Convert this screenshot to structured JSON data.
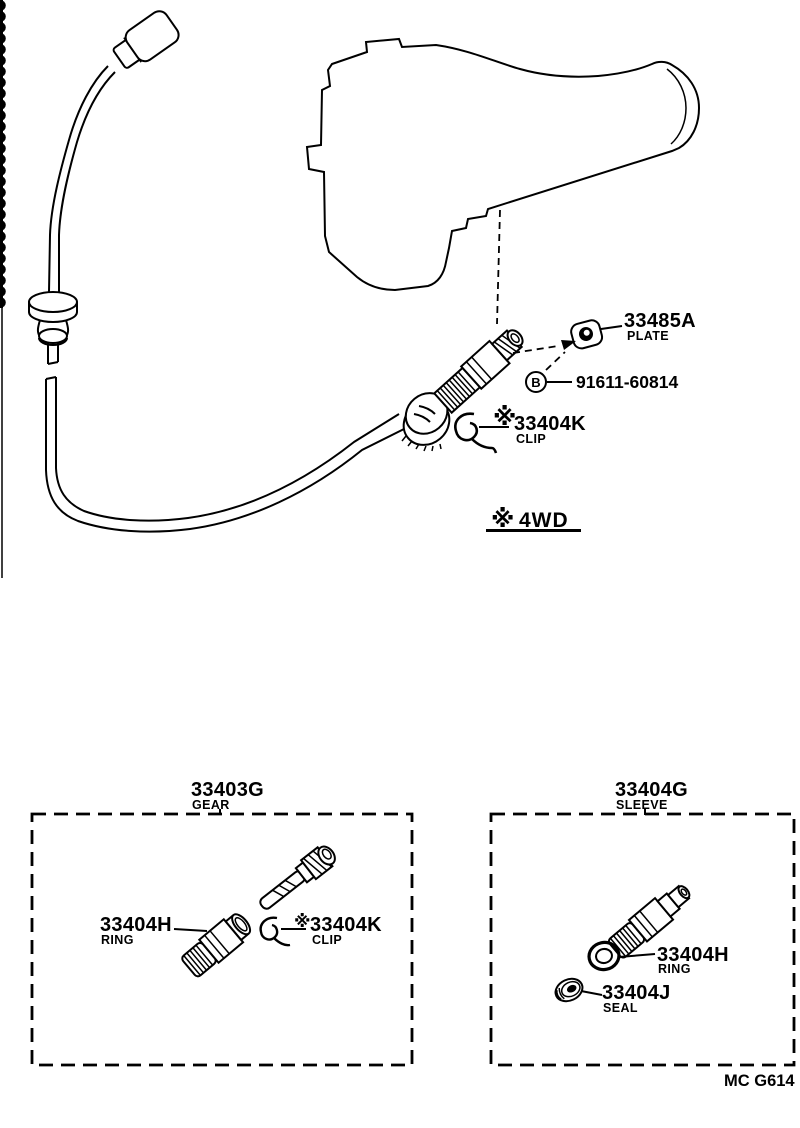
{
  "figure": {
    "plate": {
      "code": "33485A",
      "name": "PLATE"
    },
    "bolt": {
      "code": "91611-60814",
      "marker": "B"
    },
    "clip": {
      "prefix": "※",
      "code": "33404K",
      "name": "CLIP"
    },
    "note": {
      "prefix": "※",
      "text": "4WD"
    }
  },
  "gear_box": {
    "header": {
      "code": "33403G",
      "name": "GEAR"
    },
    "ring": {
      "code": "33404H",
      "name": "RING"
    },
    "clip": {
      "prefix": "※",
      "code": "33404K",
      "name": "CLIP"
    }
  },
  "sleeve_box": {
    "header": {
      "code": "33404G",
      "name": "SLEEVE"
    },
    "ring": {
      "code": "33404H",
      "name": "RING"
    },
    "seal": {
      "code": "33404J",
      "name": "SEAL"
    }
  },
  "footer": {
    "code": "MC G614"
  }
}
